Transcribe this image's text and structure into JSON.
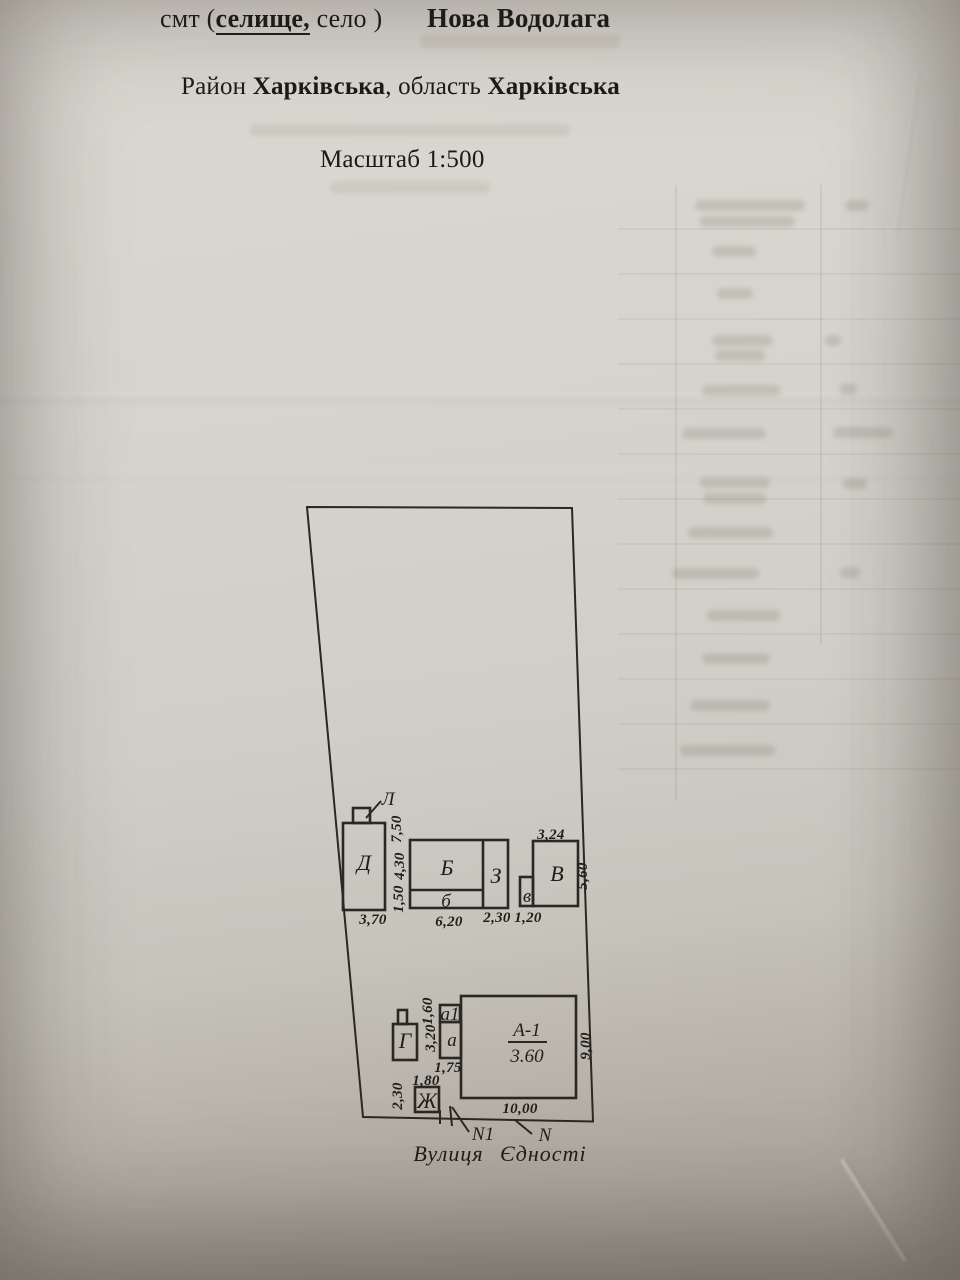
{
  "header": {
    "settlement_prefix": "смт (",
    "settlement_underlined": "селище,",
    "settlement_rest": " село )",
    "settlement_name": "Нова Водолага",
    "district_label": "Район ",
    "district": "Харківська",
    "region_label": ", область ",
    "region": "Харківська",
    "scale": "Масштаб 1:500"
  },
  "plan": {
    "street_name": "Вулиця Єдності",
    "labels": {
      "L": "Л",
      "D": "Д",
      "B": "Б",
      "b": "б",
      "Z": "З",
      "v": "в",
      "V": "В",
      "G": "Г",
      "a1": "а1",
      "a": "а",
      "Zh": "Ж",
      "A1_name": "А-1",
      "A1_area": "3.60",
      "N1": "N1",
      "N": "N"
    },
    "dimensions": {
      "D_width": "3,70",
      "D_height": "7,50",
      "B_height": "4,30",
      "b_height": "1,50",
      "B_width": "6,20",
      "Z_width": "2,30",
      "v_width": "1,20",
      "V_width": "3,24",
      "V_height": "5,60",
      "a1_height": "1,60",
      "a_height": "3,20",
      "a_width": "1,75",
      "Zh_width": "1,80",
      "Zh_height": "2,30",
      "A1_width": "10,00",
      "A1_height": "9,00"
    }
  },
  "colors": {
    "paper": "#d5d2cb",
    "ink_text": "#1c1a16",
    "ink_lines": "#2b2722"
  }
}
